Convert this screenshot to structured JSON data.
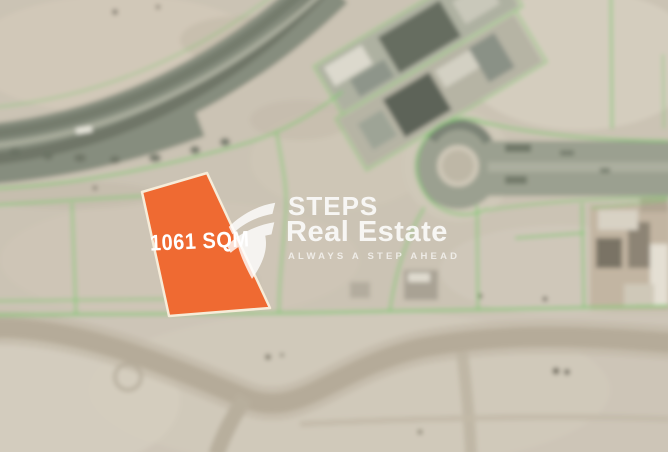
{
  "plot": {
    "area_label": "1061 SQM",
    "fill": "#EF6A32",
    "border": "#F6ECD9"
  },
  "watermark": {
    "brand_top": "STEPS",
    "brand_bottom": "Real Estate",
    "tagline": "ALWAYS A STEP AHEAD",
    "color": "#FFFFFF"
  },
  "map": {
    "boundary_color": "#82C873",
    "road_color": "#868D7E",
    "sand_color": "#CBC3B4"
  }
}
